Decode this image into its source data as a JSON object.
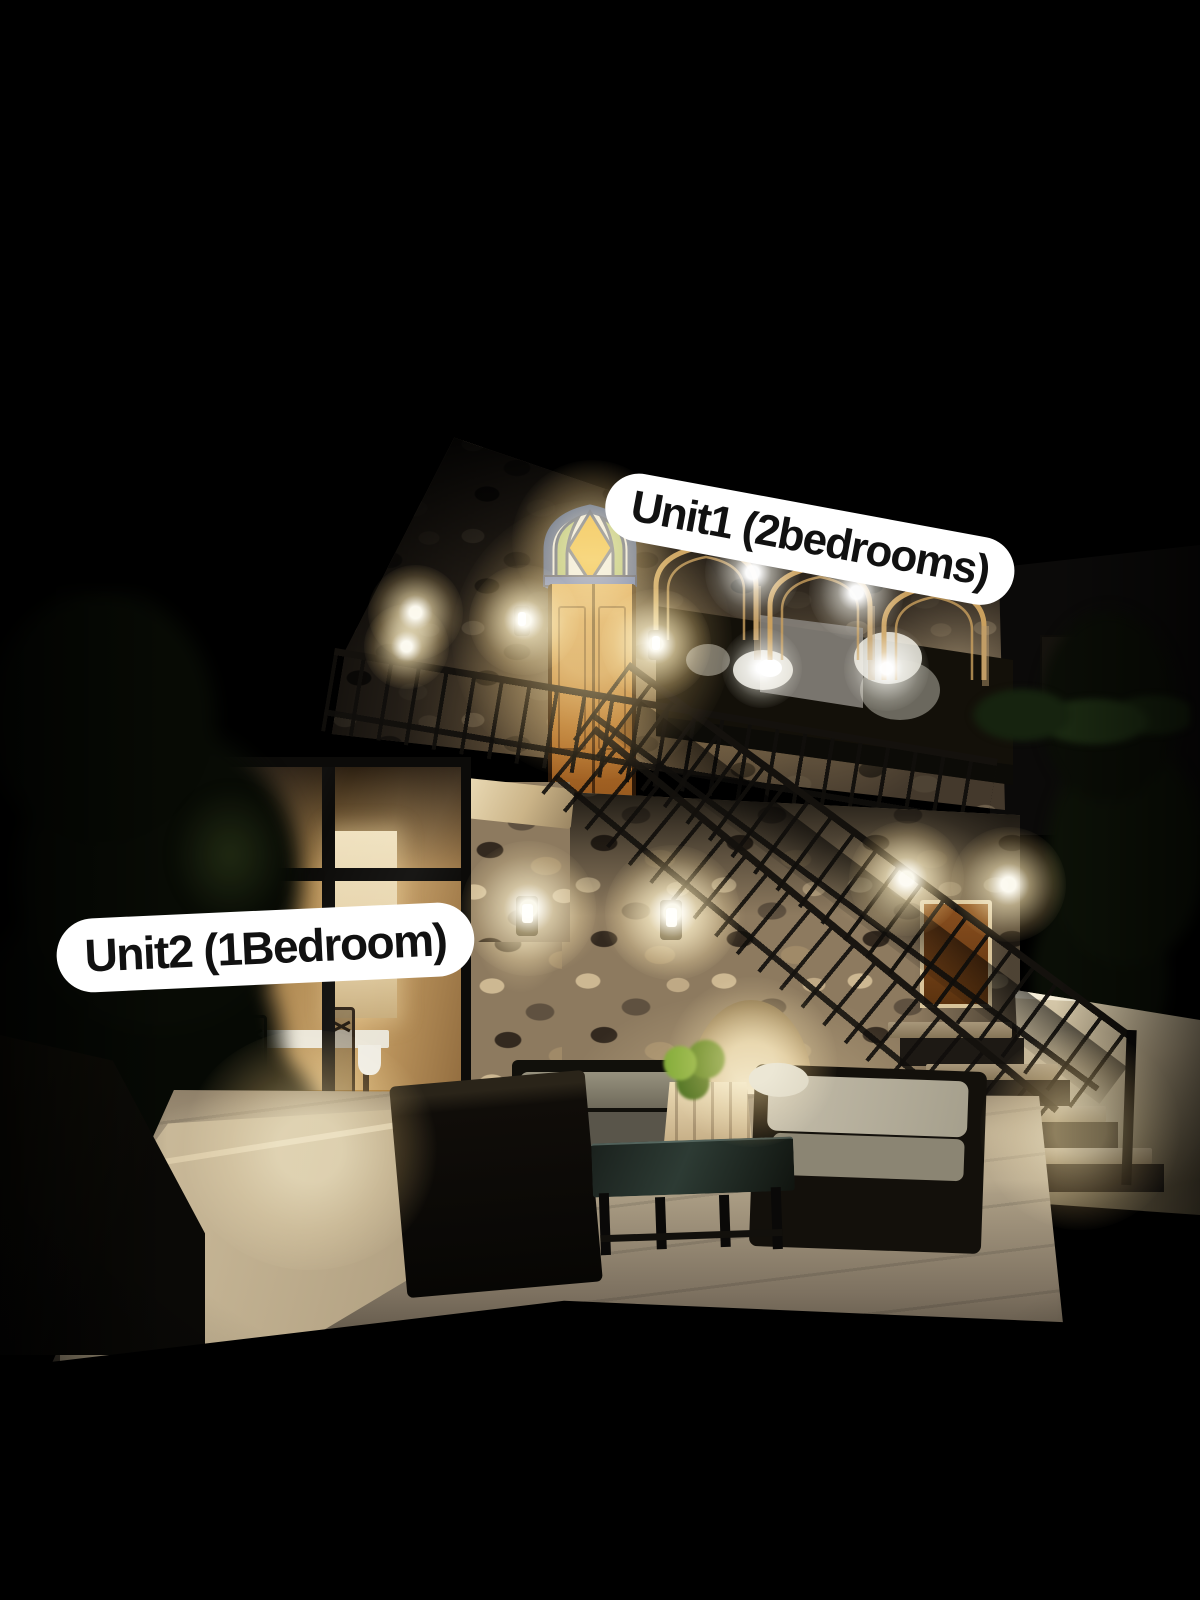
{
  "stickers": {
    "unit1": {
      "label": "Unit1 (2bedrooms)"
    },
    "unit2": {
      "label": "Unit2 (1Bedroom)"
    }
  },
  "scene": {
    "setting": "two-storey stone guesthouse photographed at night",
    "colors": {
      "sky": "#000000",
      "sticker_background": "#ffffff",
      "sticker_text": "#111111",
      "warm_light": "#ffd9a0",
      "lit_stone": "#c9b38c",
      "dark_stone": "#44392c",
      "stained_glass_orange": "#e8a124",
      "stained_glass_green": "#a3b466",
      "stained_glass_blue": "#49679c",
      "door_wood": "#b06c28"
    }
  }
}
